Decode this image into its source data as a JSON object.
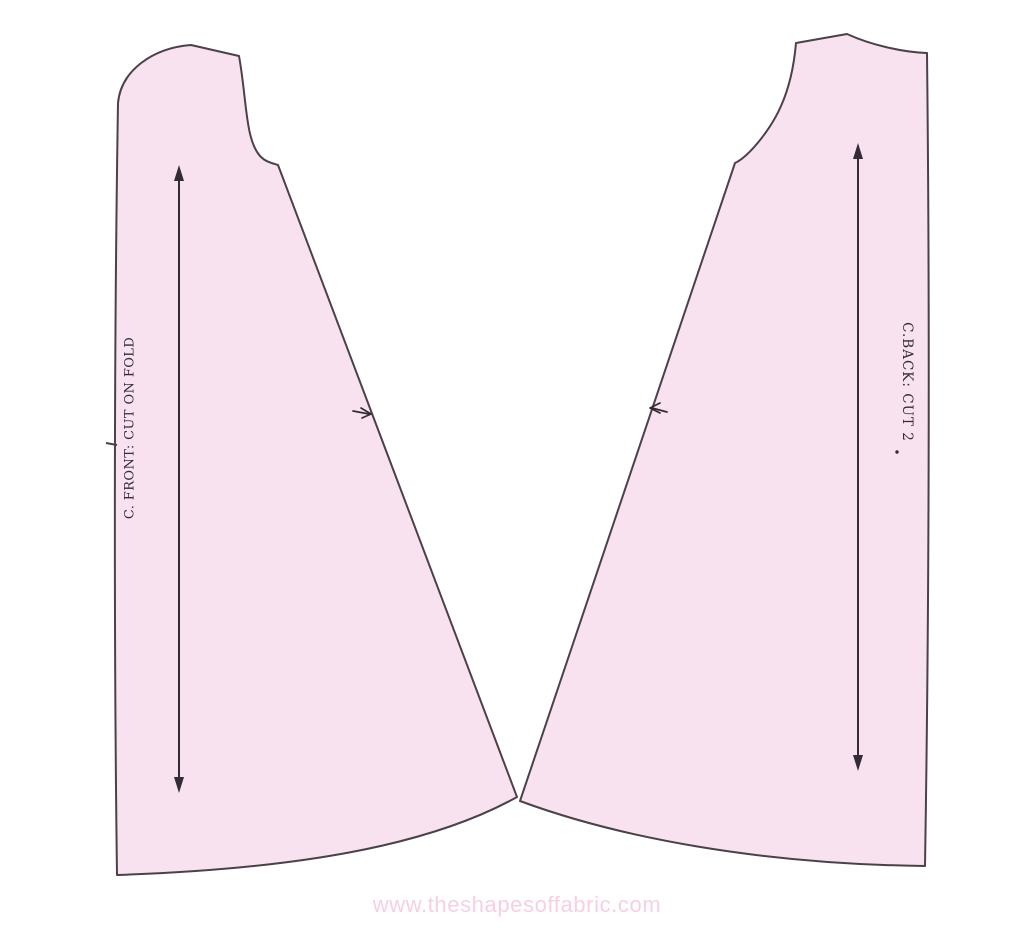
{
  "colors": {
    "background": "#ffffff",
    "piece_fill": "#f9e2f0",
    "outline": "#4b4149",
    "marking": "#332b38",
    "watermark": "#f6d0e2"
  },
  "front_piece": {
    "label": "C. FRONT: CUT ON FOLD"
  },
  "back_piece": {
    "label": "C.BACK: CUT 2"
  },
  "footer": {
    "watermark": "www.theshapesoffabric.com"
  }
}
